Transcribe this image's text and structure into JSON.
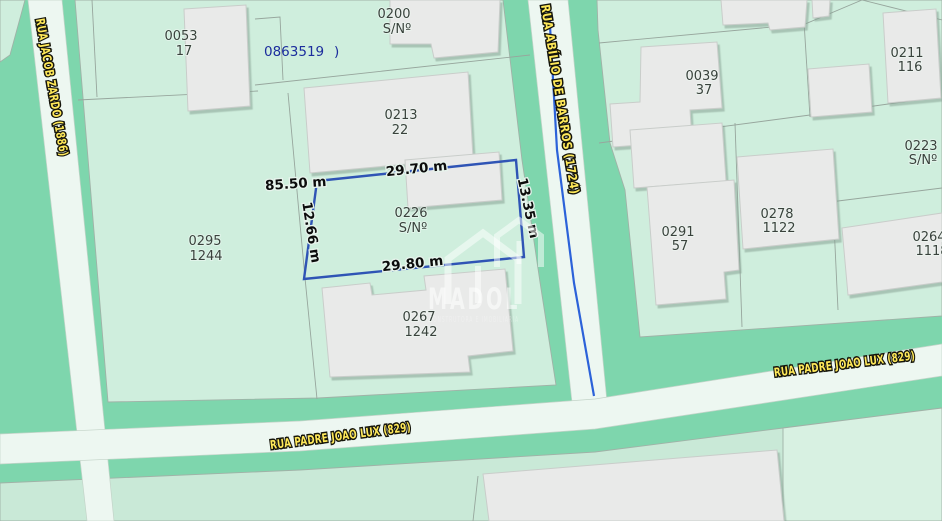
{
  "map_type": "cadastral-parcel-map",
  "streets": {
    "jacob_zardo": "RUA JACOB ZARDO (1886)",
    "abilio_de_barros": "RUA ABÍLIO DE BARROS (1724)",
    "padre_joao_lux": "RUA PADRE JOAO LUX (829)"
  },
  "sector_code": "0863519",
  "sector_code_suffix": ")",
  "parcels": {
    "p0053": {
      "code": "0053",
      "number": "17"
    },
    "p0200": {
      "code": "0200",
      "number": "S/Nº"
    },
    "p0213": {
      "code": "0213",
      "number": "22"
    },
    "p0226": {
      "code": "0226",
      "number": "S/Nº"
    },
    "p0295": {
      "code": "0295",
      "number": "1244"
    },
    "p0267": {
      "code": "0267",
      "number": "1242"
    },
    "p0039": {
      "code": "0039",
      "number": "37"
    },
    "p0211": {
      "code": "0211",
      "number": "116"
    },
    "p0223": {
      "code": "0223",
      "number": "S/Nº"
    },
    "p0291": {
      "code": "0291",
      "number": "57"
    },
    "p0278": {
      "code": "0278",
      "number": "1122"
    },
    "p0264": {
      "code": "0264",
      "number": "1118"
    }
  },
  "highlighted_lot": {
    "code": "0226",
    "number": "S/Nº",
    "measurements": {
      "front_total": "85.50 m",
      "top": "29.70 m",
      "left": "12.66 m",
      "right": "13.35 m",
      "bottom": "29.80 m"
    },
    "border_color": "#2f54b5"
  },
  "watermark": {
    "brand": "MADOL",
    "subtitle": "CONSTRUTORA E IMOBILIARIA"
  },
  "colors": {
    "corridor_green": "#7ed6ad",
    "lot_fill": "#cfeedd",
    "road_fill": "#edf7f1",
    "building_fill": "#e9eae9",
    "highlight_blue": "#2f54b5",
    "stream_blue": "#2c62d9",
    "street_label_yellow": "#ffe95a",
    "sector_code_blue": "#1c2d9d"
  }
}
